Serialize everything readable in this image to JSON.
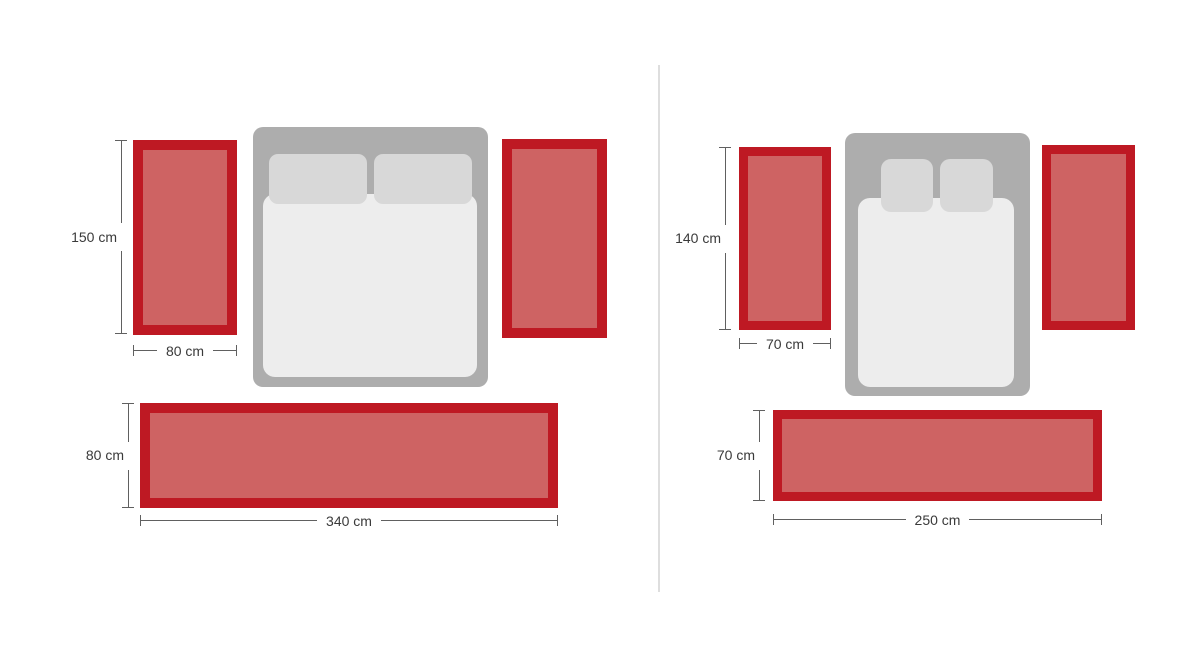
{
  "colors": {
    "background": "#ffffff",
    "rug_border": "#BE1923",
    "rug_fill": "#CE6363",
    "bed_frame": "#ADADAD",
    "pillow": "#D8D8D8",
    "duvet": "#EDEDED",
    "dimension_line": "#606060",
    "label_text": "#3A3A3A",
    "divider": "#DEDEDE"
  },
  "diagrams": [
    {
      "id": "rug-set-1",
      "side_rug": {
        "height_label": "150 cm",
        "width_label": "80 cm"
      },
      "runner_rug": {
        "height_label": "80 cm",
        "width_label": "340 cm"
      }
    },
    {
      "id": "rug-set-2",
      "side_rug": {
        "height_label": "140 cm",
        "width_label": "70 cm"
      },
      "runner_rug": {
        "height_label": "70 cm",
        "width_label": "250 cm"
      }
    }
  ]
}
